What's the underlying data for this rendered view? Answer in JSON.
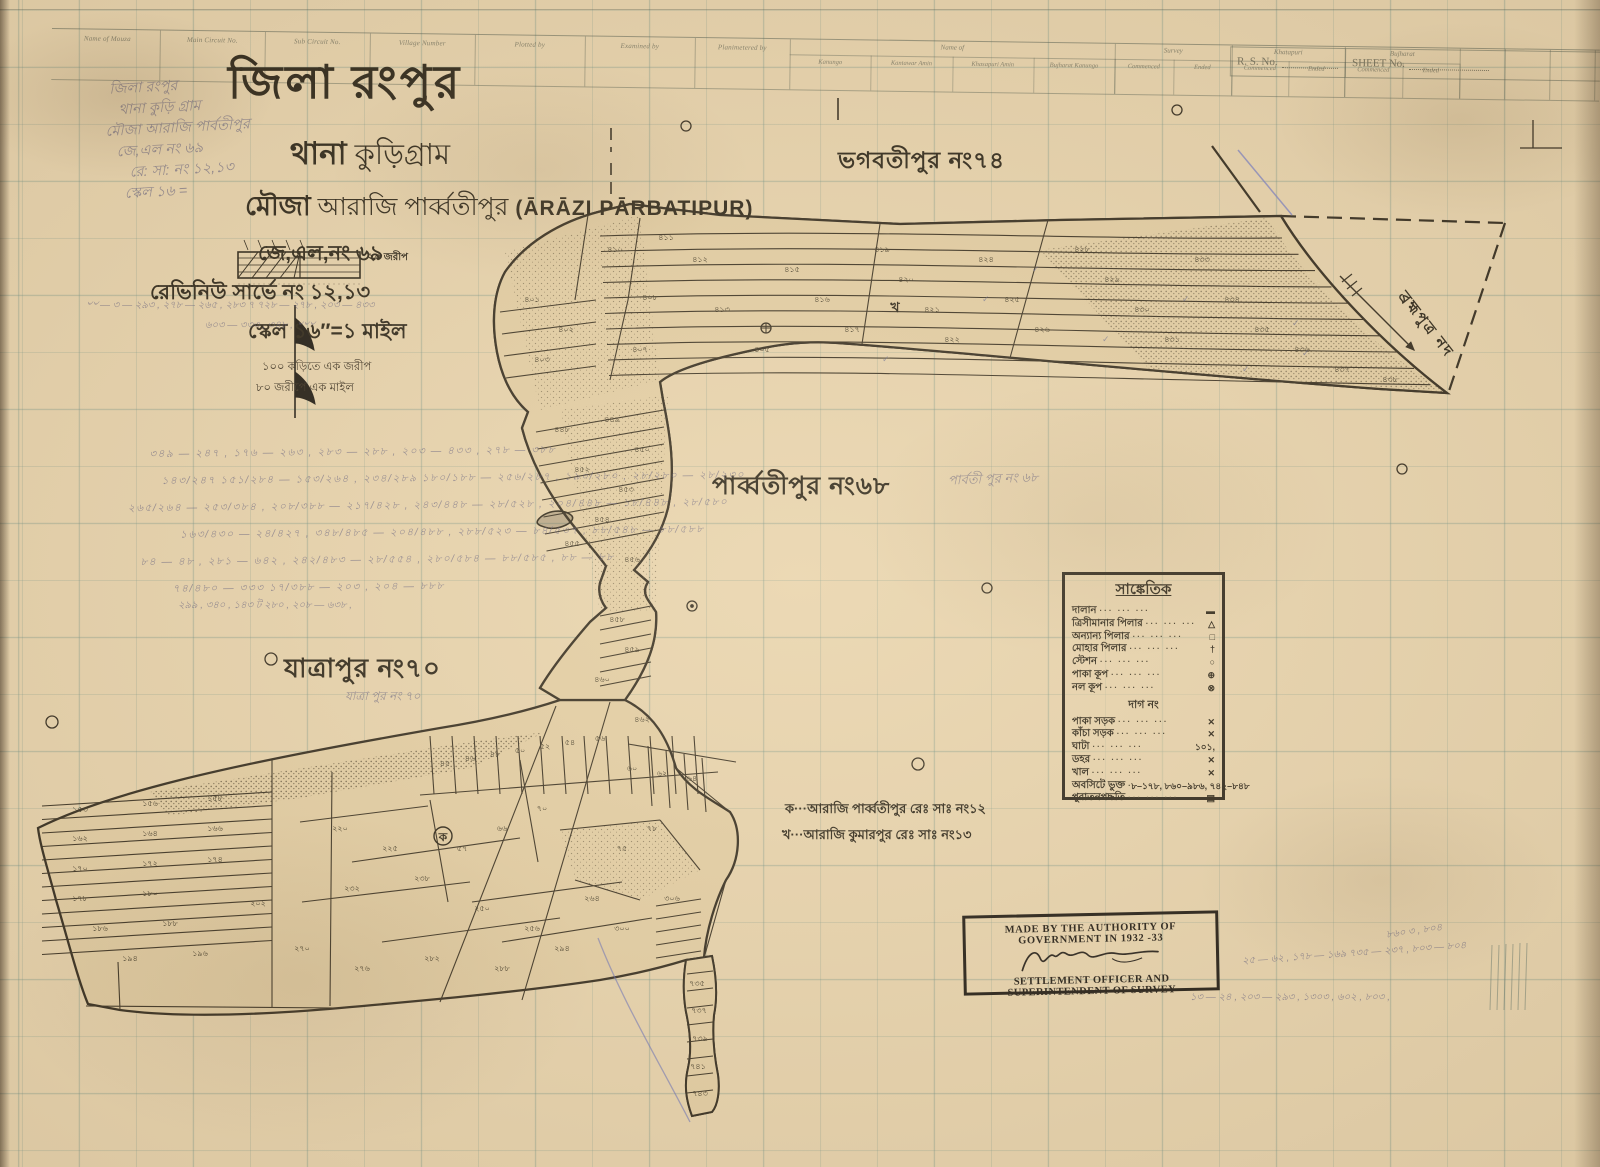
{
  "header_table": {
    "columns": [
      "Name of Mouza",
      "Main Circuit No.",
      "Sub Circuit No.",
      "Village Number",
      "Plotted by",
      "Examined by",
      "Planimetered by"
    ],
    "groups": [
      {
        "label": "Name of",
        "subs": [
          "Kanungo",
          "Kantawar Amin",
          "Khasapuri Amin",
          "Bujharat Kanungo"
        ]
      },
      {
        "label": "Survey",
        "subs": [
          "Commenced",
          "Ended"
        ]
      },
      {
        "label": "Khatapuri",
        "subs": [
          "Commenced",
          "Ended"
        ]
      },
      {
        "label": "Bujharat",
        "subs": [
          "Commenced",
          "Ended"
        ]
      }
    ],
    "rs_no_label": "R. S. No.",
    "sheet_no_label": "SHEET No."
  },
  "title_block": {
    "district_line": "জিলা রংপুর",
    "thana_label": "থানা",
    "thana": "কুড়িগ্রাম",
    "mouza_label": "মৌজা",
    "mouza": "আরাজি পার্ব্বতীপুর",
    "mouza_latin": "(ĀRĀZI PĀRBATIPUR)",
    "jl_line": "জে,এল,নং ৬৯",
    "revenue_line": "রেভিনিউ সার্ভে নং ১২,১৩",
    "scale_line": "স্কেল ১৬″=১ মাইল",
    "scale_note1": "১০০ কড়িতে এক জরীপ",
    "scale_note2": "৮০ জরীপে এক মাইল",
    "scale_bar_label": "২০ জরীপ"
  },
  "map": {
    "neighbors": [
      {
        "name": "ভগবতীপুর নং৭৪"
      },
      {
        "name": "পার্ব্বতীপুর নং৬৮"
      },
      {
        "name": "যাত্রাপুর নং৭০"
      }
    ],
    "river_label": "ব্রহ্মপুত্র নদ",
    "plot_letter_ka": "ক",
    "plot_letter_kha": "খ",
    "plot_numbers": [
      [
        615,
        252,
        "৪১০"
      ],
      [
        650,
        300,
        "৪০৮"
      ],
      [
        640,
        352,
        "৪০৭"
      ],
      [
        700,
        262,
        "৪১২"
      ],
      [
        722,
        312,
        "৪১৩"
      ],
      [
        762,
        352,
        "৪০৫"
      ],
      [
        792,
        272,
        "৪১৫"
      ],
      [
        822,
        302,
        "৪১৬"
      ],
      [
        852,
        332,
        "৪১৭"
      ],
      [
        882,
        252,
        "৪১৯"
      ],
      [
        906,
        282,
        "৪২০"
      ],
      [
        932,
        312,
        "৪২১"
      ],
      [
        952,
        342,
        "৪২২"
      ],
      [
        986,
        262,
        "৪২৪"
      ],
      [
        1012,
        302,
        "৪২৫"
      ],
      [
        1042,
        332,
        "৪২৬"
      ],
      [
        1082,
        252,
        "৪২৮"
      ],
      [
        1112,
        282,
        "৪২৯"
      ],
      [
        1142,
        312,
        "৪৩০"
      ],
      [
        1172,
        342,
        "৪৩১"
      ],
      [
        1202,
        262,
        "৪৩৩"
      ],
      [
        1232,
        302,
        "৪৩৪"
      ],
      [
        1262,
        332,
        "৪৩৫"
      ],
      [
        1302,
        352,
        "৪৩৬"
      ],
      [
        1342,
        372,
        "৪৩৭"
      ],
      [
        666,
        240,
        "৪১১"
      ],
      [
        566,
        332,
        "৪০২"
      ],
      [
        532,
        302,
        "৪০১"
      ],
      [
        542,
        362,
        "৪০৩"
      ],
      [
        1390,
        382,
        "৪৩৮"
      ],
      [
        562,
        432,
        "৪৪৮"
      ],
      [
        612,
        422,
        "৪৪৯"
      ],
      [
        642,
        452,
        "৪৫০"
      ],
      [
        582,
        472,
        "৪৫২"
      ],
      [
        626,
        492,
        "৪৫৩"
      ],
      [
        602,
        522,
        "৪৫৪"
      ],
      [
        572,
        546,
        "৪৫৫"
      ],
      [
        632,
        562,
        "৪৫৬"
      ],
      [
        617,
        622,
        "৪৫৮"
      ],
      [
        632,
        652,
        "৪৫৯"
      ],
      [
        602,
        682,
        "৪৬০"
      ],
      [
        642,
        722,
        "৪৬২"
      ],
      [
        80,
        812,
        "১৫৩"
      ],
      [
        150,
        806,
        "১৫৬"
      ],
      [
        215,
        801,
        "১৫৮"
      ],
      [
        80,
        841,
        "১৬২"
      ],
      [
        150,
        836,
        "১৬৪"
      ],
      [
        215,
        831,
        "১৬৬"
      ],
      [
        80,
        871,
        "১৭০"
      ],
      [
        150,
        866,
        "১৭২"
      ],
      [
        215,
        862,
        "১৭৪"
      ],
      [
        80,
        901,
        "১৭৮"
      ],
      [
        150,
        896,
        "১৮০"
      ],
      [
        100,
        931,
        "১৮৬"
      ],
      [
        170,
        926,
        "১৮৮"
      ],
      [
        130,
        961,
        "১৯৪"
      ],
      [
        200,
        956,
        "১৯৬"
      ],
      [
        258,
        906,
        "২০২"
      ],
      [
        445,
        766,
        "৪৫"
      ],
      [
        470,
        761,
        "৪৬"
      ],
      [
        495,
        757,
        "৪৮"
      ],
      [
        520,
        753,
        "৫০"
      ],
      [
        545,
        749,
        "৫২"
      ],
      [
        570,
        745,
        "৫৪"
      ],
      [
        600,
        741,
        "৫৬"
      ],
      [
        632,
        771,
        "৬০"
      ],
      [
        662,
        776,
        "৬২"
      ],
      [
        692,
        781,
        "৬৪"
      ],
      [
        340,
        831,
        "২২০"
      ],
      [
        390,
        851,
        "২২৫"
      ],
      [
        352,
        891,
        "২৩২"
      ],
      [
        422,
        881,
        "২৩৮"
      ],
      [
        462,
        851,
        "৫৭"
      ],
      [
        502,
        831,
        "৬৬"
      ],
      [
        542,
        811,
        "৭০"
      ],
      [
        482,
        911,
        "২৫০"
      ],
      [
        532,
        931,
        "২৫৬"
      ],
      [
        592,
        901,
        "২৬৪"
      ],
      [
        622,
        851,
        "৭৫"
      ],
      [
        652,
        831,
        "৭৮"
      ],
      [
        302,
        951,
        "২৭০"
      ],
      [
        362,
        971,
        "২৭৬"
      ],
      [
        432,
        961,
        "২৮২"
      ],
      [
        502,
        971,
        "২৮৮"
      ],
      [
        562,
        951,
        "২৯৪"
      ],
      [
        622,
        931,
        "৩০০"
      ],
      [
        672,
        901,
        "৩০৬"
      ],
      [
        697,
        986,
        "৭৩৫"
      ],
      [
        699,
        1013,
        "৭৩৭"
      ],
      [
        700,
        1041,
        "৭৩৯"
      ],
      [
        698,
        1069,
        "৭৪১"
      ],
      [
        700,
        1096,
        "৭৪৩"
      ]
    ],
    "check_marks": [
      [
        1292,
        326
      ],
      [
        1302,
        356
      ],
      [
        1182,
        302
      ],
      [
        1242,
        372
      ],
      [
        982,
        302
      ],
      [
        1102,
        342
      ],
      [
        882,
        362
      ],
      [
        1032,
        272
      ]
    ]
  },
  "legend": {
    "title": "সাঙ্কেতিক",
    "dag_header": "দাগ নং",
    "rows_top": [
      {
        "label": "দালান",
        "symbol": "▬"
      },
      {
        "label": "ত্রিসীমানার পিলার",
        "symbol": "△"
      },
      {
        "label": "অন্যান্য পিলার",
        "symbol": "□"
      },
      {
        "label": "মোহার পিলার",
        "symbol": "†"
      },
      {
        "label": "স্টেশন",
        "symbol": "○"
      },
      {
        "label": "পাকা কূপ",
        "symbol": "⊕"
      },
      {
        "label": "নল কূপ",
        "symbol": "⊗"
      }
    ],
    "rows_bottom": [
      {
        "label": "পাকা সড়ক",
        "symbol": "✕"
      },
      {
        "label": "কাঁচা সড়ক",
        "symbol": "✕"
      },
      {
        "label": "ঘাটা",
        "symbol": "১০১,"
      },
      {
        "label": "ডহর",
        "symbol": "✕"
      },
      {
        "label": "খাল",
        "symbol": "✕"
      },
      {
        "label": "অবসিটে ভুক্ত",
        "symbol": "৮–১৭৮, ৮৬০–৯৮৬, ৭৪২–৮৪৮",
        "tiny": true
      },
      {
        "label": "পুরাতনপদ্ধতি",
        "symbol": "▤"
      }
    ]
  },
  "notes": {
    "ka": "ক···আরাজি পার্ব্বতীপুর  রেঃ সাঃ নং১২",
    "kha": "খ···আরাজি কুমারপুর  রেঃ সাঃ নং১৩"
  },
  "stamp": {
    "line1": "MADE BY THE AUTHORITY OF GOVERNMENT IN 1932 -33",
    "line2": "SETTLEMENT OFFICER AND SUPERINTENDENT OF SURVEY"
  },
  "annotations": {
    "top_left": [
      "জিলা রংপুর",
      "থানা কুড়ি গ্রাম",
      "মৌজা আরাজি পার্বতীপুর",
      "জে,এল নং ৬৯",
      "রে: সা: নং ১২,১৩",
      "স্কেল ১৬ ="
    ],
    "near_title_1": "৺৺ — ৩ — ২৯৩ , ২৭৮ — ২৬৫ , ২৮৩ ৭ ৭২৮ — ২৭৮ , ২০৩ — ৪৩৩",
    "near_title_2": "৬০৩ — ৩৩৩ , ৩৪৮ , ৺৺৺",
    "fraction_rows": [
      "৩৪৯ — ২৪৭ , ১৭৬ — ২৬৩ , ২৮৩ — ২৮৮ , ২০৩ — ৪৩৩ , ২৭৮ — ৩৮৮",
      "১৪৩/২৪৭  ১৫১/২৮৪ — ১৫৩/২৬৪ , ২৩৪/২৮৯  ১৮০/১৮৮ — ২৫৬/২৮৭ , ১৯০/২৮০ , ২৮/২৮০ — ২৮/২৩০",
      "২৬৫/২৬৪ — ২৫৩/৩৮৪ , ২০৮/৩৮৮ — ২১৭/৪২৮ , ২৪৩/৪৪৮ — ২৮/৫২৮ , ২০৪/৪৪৮ — ১৮/৪৪৮ , ২৮/৫৮০",
      "১৬৩/৪৩০ — ২৪/৪২৭ , ৩৪৮/৪৮৫ — ২০৪/৪৮৮ , ২৮৮/৫২৩ — ৮৪/৫৩৭ , ৮৮/৫৪৮ — ৮৮/৫৮৮",
      "৮৪ — ৪৮ , ২৮১ — ৬৪২ , ২৪২/৪৮৩ — ২৮/৫৫৪ , ২৮০/৫৮৪ — ৮৮/৫৮৫ , ৮৮ — ৮৮",
      "৭৪/৪৮০ — ৩৩৩  ১৭/৩৮৮ — ২০৩ , ২০৪ — ৮৮৮"
    ],
    "frac_tail": "২৯৯ , ৩৪০ , ১৪৩ ট ২৮০ , ২০৮ — ৬৩৮ ,",
    "near_stamp_1": "২৫ — ৬২ , ১৭৮ — ১৬৯  ৭৩৫ — ২৩৭ , ৮০৩ — ৮০৪",
    "near_stamp_0": "৮৬০ ৩ , ৮০৪",
    "near_stamp_2": "১৩ — ২৪ , ২০৩ — ২৯৩ , ১৩০৩ , ৬০২ , ৮০৩ ,",
    "echo_parbatipur": "পার্বতী পুর  নং ৬৮",
    "echo_jatrapur": "যাত্রা পুর  নং ৭০"
  }
}
